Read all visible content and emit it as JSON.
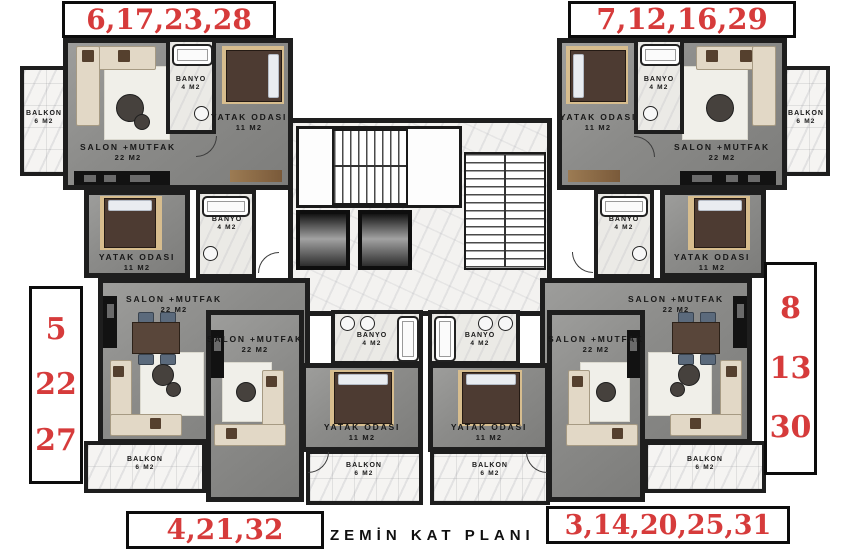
{
  "title": "ZEMİN KAT PLANI",
  "apartment_numbers": {
    "top_left": "6,17,23,28",
    "top_right": "7,12,16,29",
    "mid_left": [
      "5",
      "22",
      "27"
    ],
    "mid_right": [
      "8",
      "13",
      "30"
    ],
    "bottom_left": "4,21,32",
    "bottom_right": "3,14,20,25,31"
  },
  "room_types": {
    "salon": {
      "name": "SALON +MUTFAK",
      "area": "22 M2"
    },
    "banyo": {
      "name": "BANYO",
      "area": "4 M2"
    },
    "bedroom": {
      "name": "YATAK ODASI",
      "area": "11 M2"
    },
    "balcony": {
      "name": "BALKON",
      "area": "6 M2"
    }
  },
  "colors": {
    "annotation_red": "#d63b3b",
    "wall_black": "#1e1e1e",
    "floor_gray": "#8b8b89",
    "marble_white": "#f3f2f0",
    "sofa_beige": "#e2d8c6",
    "bed_brown": "#4d3b32",
    "rug_tan": "#d7bd8e",
    "wood": "#8a6b47"
  }
}
